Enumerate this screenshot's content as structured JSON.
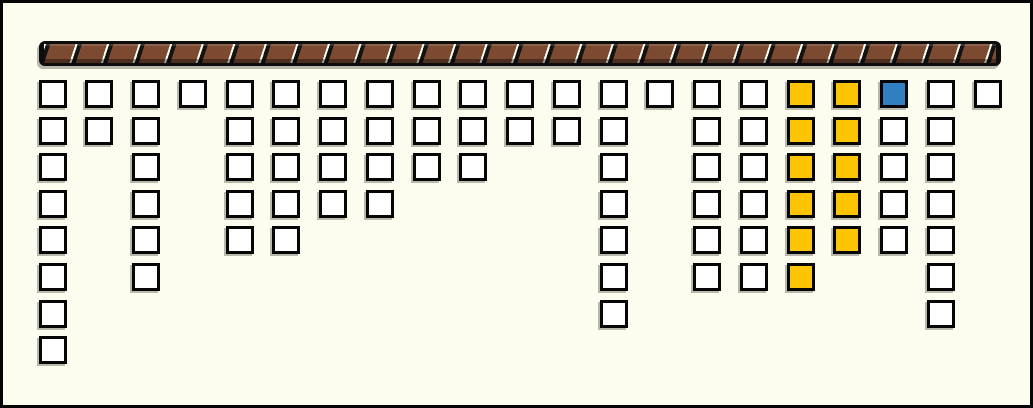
{
  "window": {
    "background": "#FDFDEF",
    "frame_color": "#050505",
    "shadow_color": "#9A9A90"
  },
  "beam": {
    "kind": "hatched-horizontal-beam",
    "segment_color": "#7B4A31",
    "separator_line_color": "#FDFCEE",
    "gap_color": "#131313",
    "outline_color": "#0D0D0D"
  },
  "board": {
    "columns_count": 21,
    "max_rows": 8,
    "colors": {
      "W": "#FFFFFF",
      "Y": "#FCC503",
      "B": "#2F7FC1"
    },
    "columns": [
      {
        "index": 1,
        "cells": [
          "W",
          "W",
          "W",
          "W",
          "W",
          "W",
          "W",
          "W"
        ]
      },
      {
        "index": 2,
        "cells": [
          "W",
          "W"
        ]
      },
      {
        "index": 3,
        "cells": [
          "W",
          "W",
          "W",
          "W",
          "W",
          "W"
        ]
      },
      {
        "index": 4,
        "cells": [
          "W"
        ]
      },
      {
        "index": 5,
        "cells": [
          "W",
          "W",
          "W",
          "W",
          "W"
        ]
      },
      {
        "index": 6,
        "cells": [
          "W",
          "W",
          "W",
          "W",
          "W"
        ]
      },
      {
        "index": 7,
        "cells": [
          "W",
          "W",
          "W",
          "W"
        ]
      },
      {
        "index": 8,
        "cells": [
          "W",
          "W",
          "W",
          "W"
        ]
      },
      {
        "index": 9,
        "cells": [
          "W",
          "W",
          "W"
        ]
      },
      {
        "index": 10,
        "cells": [
          "W",
          "W",
          "W"
        ]
      },
      {
        "index": 11,
        "cells": [
          "W",
          "W"
        ]
      },
      {
        "index": 12,
        "cells": [
          "W",
          "W"
        ]
      },
      {
        "index": 13,
        "cells": [
          "W",
          "W",
          "W",
          "W",
          "W",
          "W",
          "W"
        ]
      },
      {
        "index": 14,
        "cells": [
          "W"
        ]
      },
      {
        "index": 15,
        "cells": [
          "W",
          "W",
          "W",
          "W",
          "W",
          "W"
        ]
      },
      {
        "index": 16,
        "cells": [
          "W",
          "W",
          "W",
          "W",
          "W",
          "W"
        ]
      },
      {
        "index": 17,
        "cells": [
          "Y",
          "Y",
          "Y",
          "Y",
          "Y",
          "Y"
        ]
      },
      {
        "index": 18,
        "cells": [
          "Y",
          "Y",
          "Y",
          "Y",
          "Y"
        ]
      },
      {
        "index": 19,
        "cells": [
          "B",
          "W",
          "W",
          "W",
          "W"
        ]
      },
      {
        "index": 20,
        "cells": [
          "W",
          "W",
          "W",
          "W",
          "W",
          "W",
          "W"
        ]
      },
      {
        "index": 21,
        "cells": [
          "W"
        ]
      }
    ],
    "column_heights": [
      8,
      2,
      6,
      1,
      5,
      5,
      4,
      4,
      3,
      3,
      2,
      2,
      7,
      1,
      6,
      6,
      6,
      5,
      5,
      7,
      1
    ],
    "summary": {
      "total_tiles": 89,
      "white_tiles": 77,
      "yellow_tiles": 11,
      "blue_tiles": 1
    }
  }
}
